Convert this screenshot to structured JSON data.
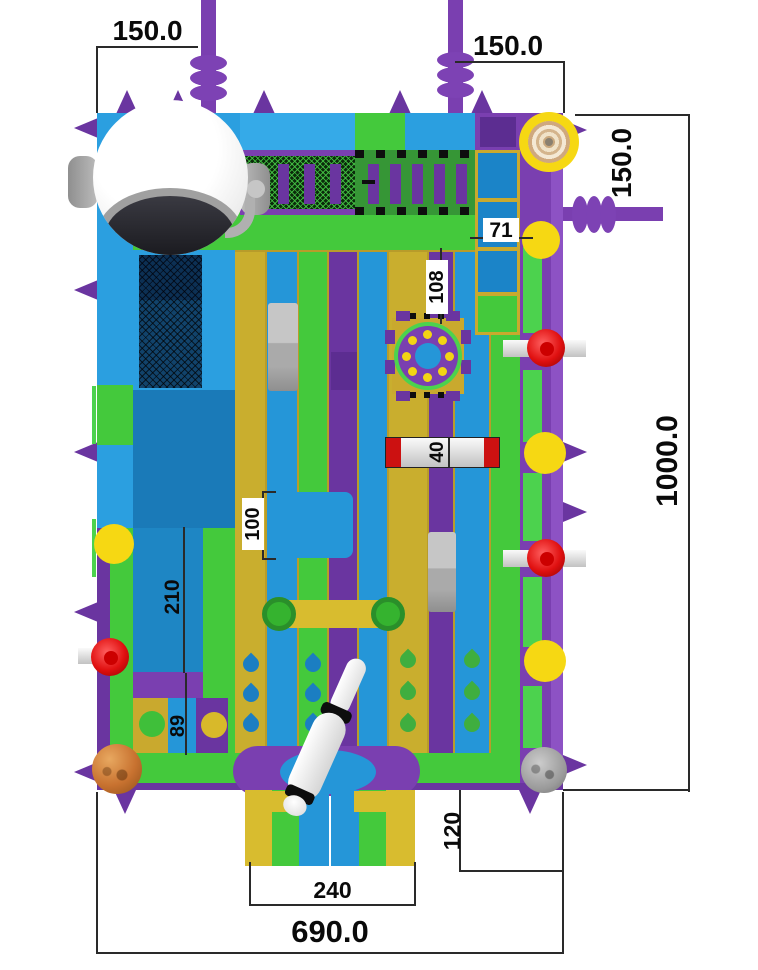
{
  "drawing": {
    "title": "inflatable-playground-top-view-plan",
    "dims": {
      "top_left": "150.0",
      "top_right": "150.0",
      "right_upper": "150.0",
      "right_full": "1000.0",
      "bottom_full": "690.0",
      "slide_width": "240",
      "slide_depth": "120",
      "gap_71": "71",
      "lane_108": "108",
      "beam_40": "40",
      "box_100": "100",
      "pool_210": "210",
      "cell_89": "89"
    },
    "palette": {
      "frame_green": "#3fbf3a",
      "blue": "#2b9fe0",
      "pool_blue": "#1a7ab8",
      "purple": "#7a3fb0",
      "gold_lane": "#c9ae2e",
      "yellow_ball": "#f6d813",
      "red_ball": "#e01010",
      "silver_beam": "#d9d9d9",
      "white": "#ffffff"
    },
    "objects": [
      "astronaut-helmet",
      "mesh-tunnel",
      "spiral-top",
      "carousel",
      "crash-beam",
      "yellow-tube",
      "climb-net",
      "baseball-bat",
      "planet-ball",
      "moon-ball",
      "slide-exit",
      "bumper-pill"
    ]
  }
}
